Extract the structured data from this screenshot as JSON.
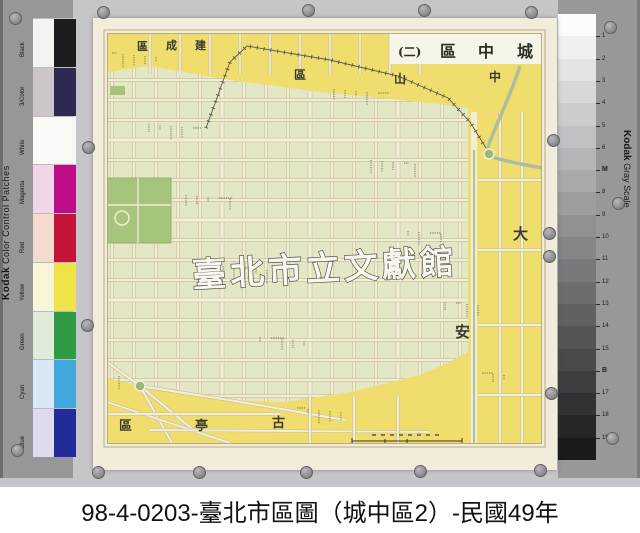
{
  "caption": "98-4-0203-臺北市區圖（城中區2）-民國49年",
  "watermark": "臺北市立文獻館",
  "map_title_chars": [
    "城",
    "中",
    "區",
    "(二)"
  ],
  "districts": {
    "zhongshan": [
      "中",
      "山",
      "區"
    ],
    "jiancheng": [
      "建",
      "成",
      "區"
    ],
    "daan": [
      "大",
      "安"
    ],
    "guting": [
      "古",
      "亭",
      "區"
    ]
  },
  "color_strip": {
    "brand": "Kodak",
    "title": "Color Control Patches",
    "patches": [
      {
        "label": "Black",
        "tint": "#f4f4f2",
        "full": "#1d1d20"
      },
      {
        "label": "3/Color",
        "tint": "#ccc6ca",
        "full": "#2d2950"
      },
      {
        "label": "White",
        "tint": "#fafaf7",
        "full": "#f9f9f6"
      },
      {
        "label": "Magenta",
        "tint": "#f0d6e6",
        "full": "#bf0d89"
      },
      {
        "label": "Red",
        "tint": "#f6dccf",
        "full": "#c31337"
      },
      {
        "label": "Yellow",
        "tint": "#faf5d6",
        "full": "#f1e448"
      },
      {
        "label": "Green",
        "tint": "#e0ecd9",
        "full": "#2f9b45"
      },
      {
        "label": "Cyan",
        "tint": "#d8e9f5",
        "full": "#41a7dc"
      },
      {
        "label": "Blue",
        "tint": "#e0daed",
        "full": "#232a9a"
      }
    ]
  },
  "gray_scale": {
    "brand": "Kodak",
    "title": "Gray Scale",
    "steps_count": 20,
    "ticks": [
      "1",
      "2",
      "3",
      "4",
      "5",
      "6",
      "M",
      "8",
      "9",
      "10",
      "11",
      "12",
      "13",
      "14",
      "15",
      "B",
      "17",
      "18",
      "19"
    ],
    "dots": [
      {
        "letter": "C",
        "color": "#35b0e5"
      },
      {
        "letter": "Y",
        "color": "#edcb37"
      },
      {
        "letter": "M",
        "color": "#c2188e"
      }
    ]
  },
  "map_colors": {
    "paper": "#f1ecdc",
    "yellow_district": "#efde6e",
    "city_block_green": "#e4e7c6",
    "street_cream": "#f3eed9",
    "park_green": "#a6c47c",
    "river_green": "#a9bba2",
    "frame_brown": "#b3a67c"
  }
}
